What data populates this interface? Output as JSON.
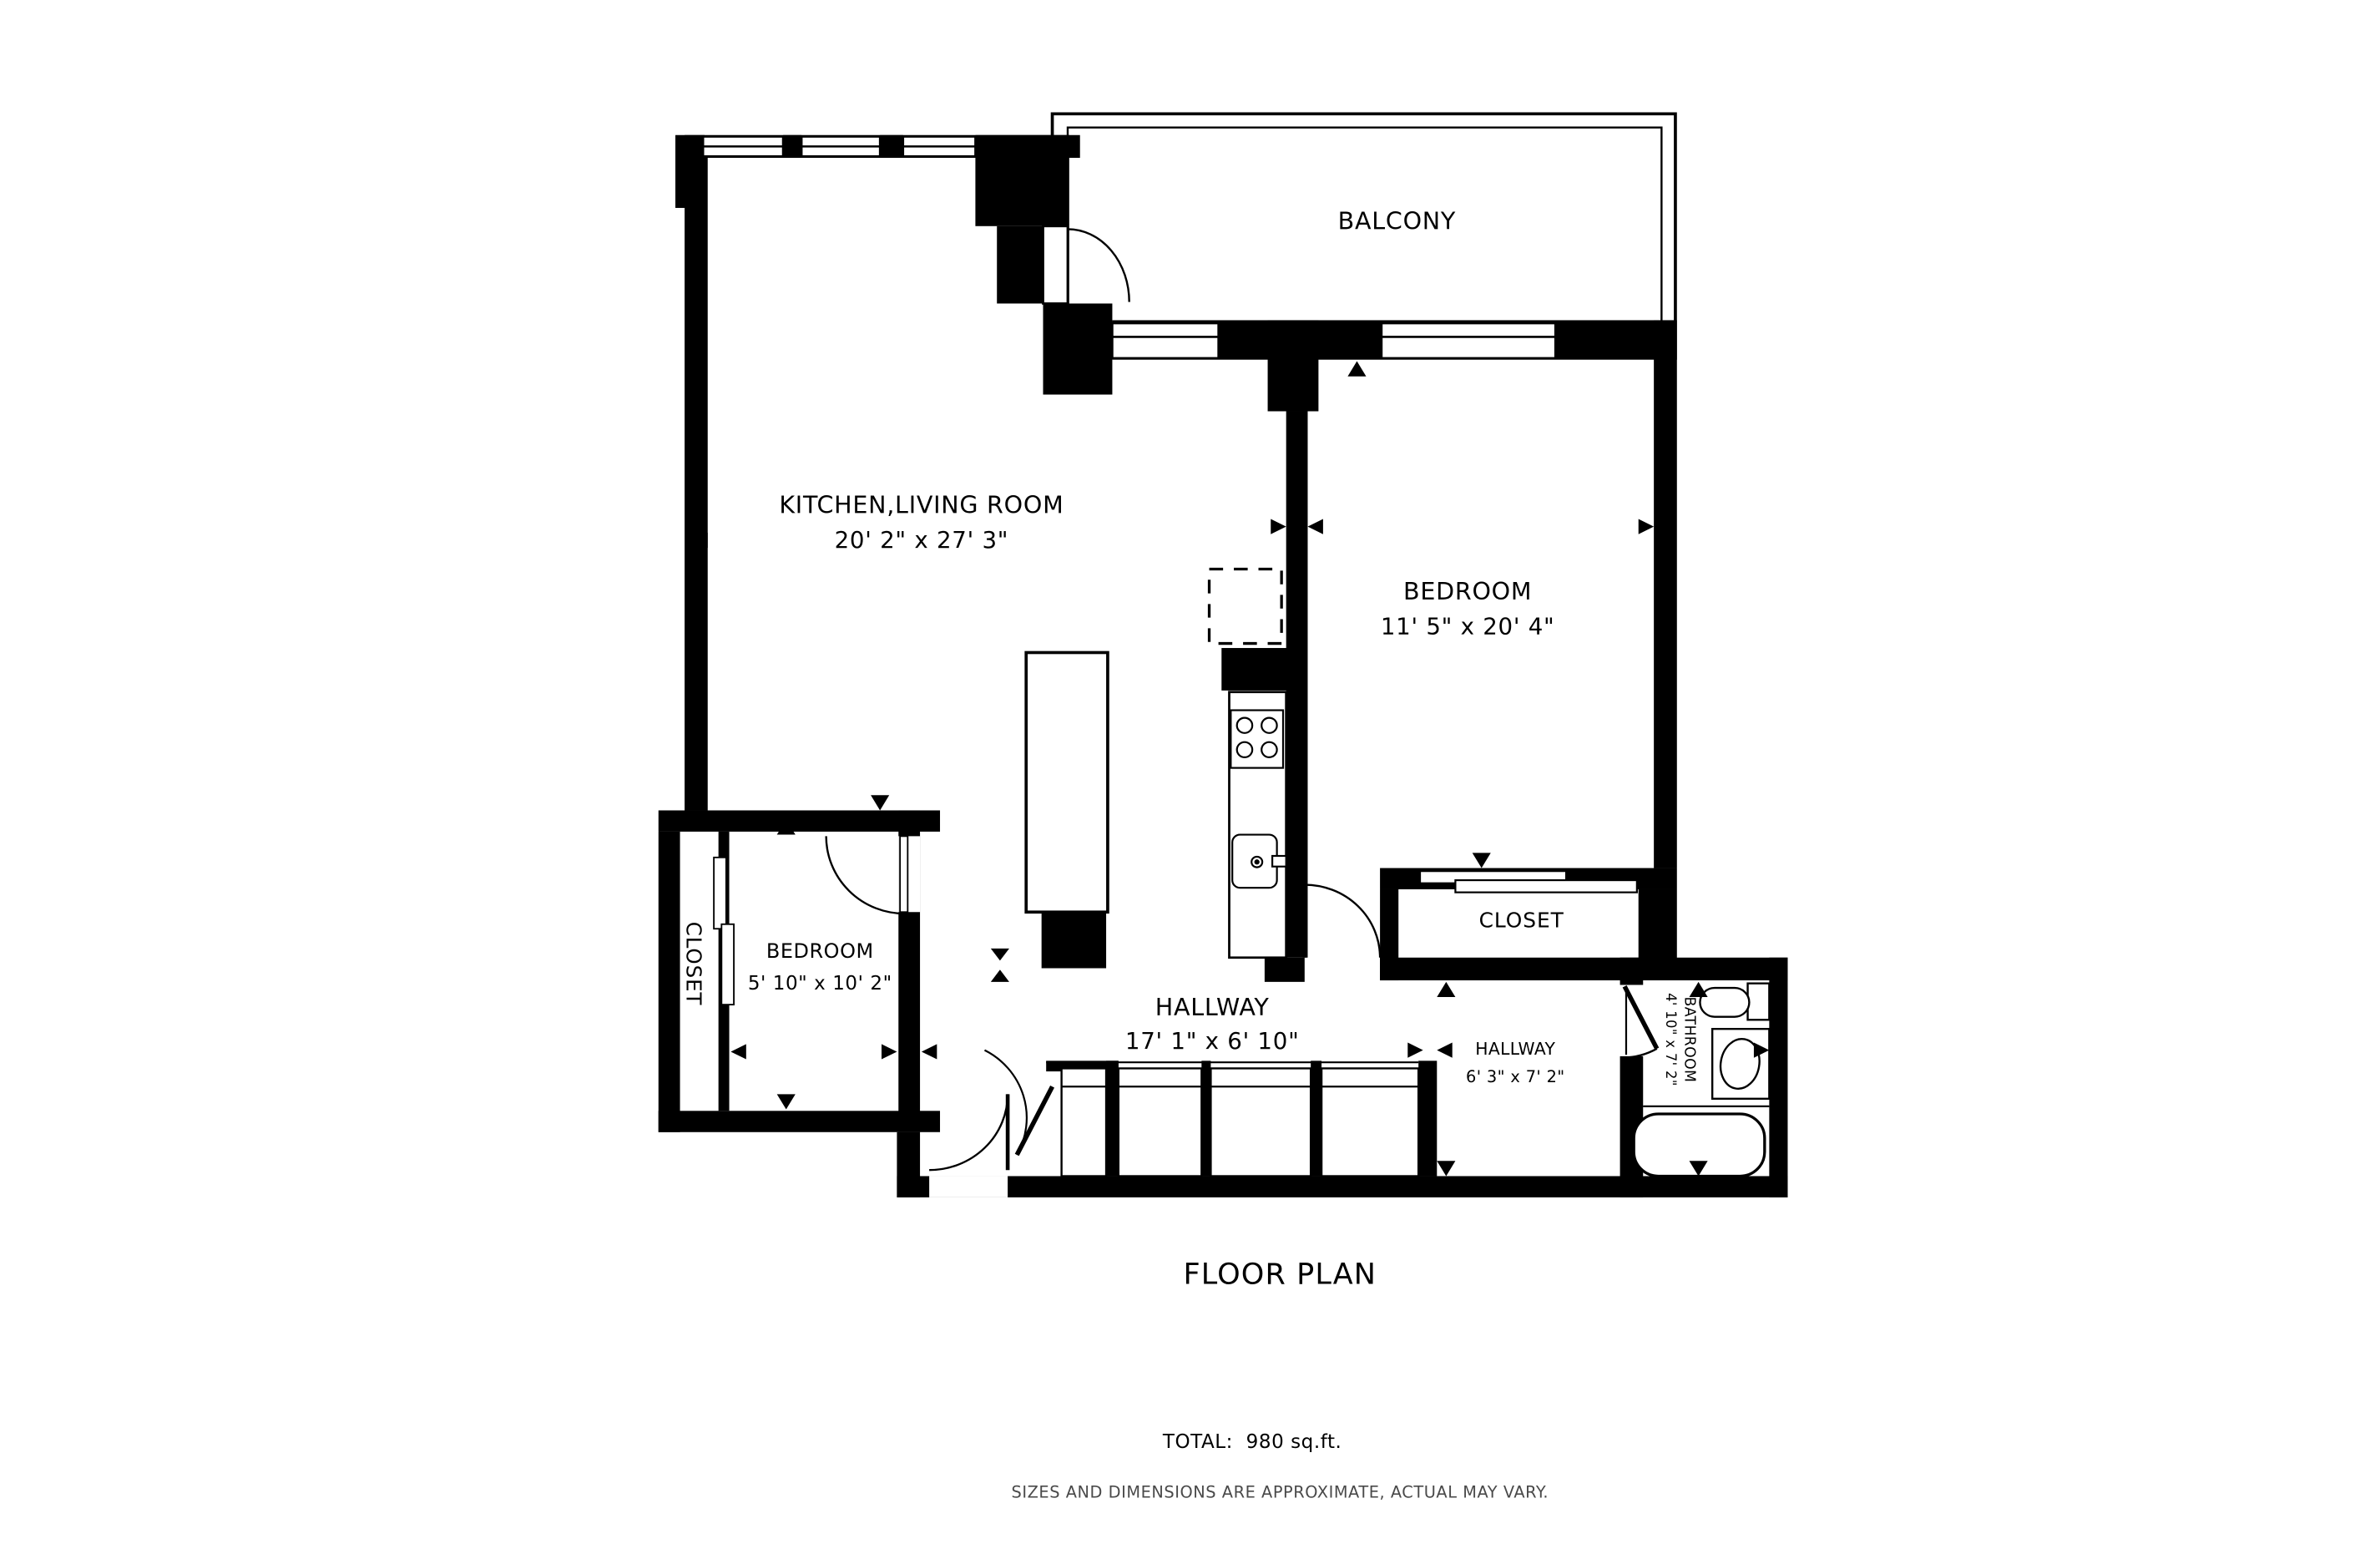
{
  "plan": {
    "title": "FLOOR PLAN",
    "total_label": "TOTAL:  980 sq.ft.",
    "disclaimer": "SIZES AND DIMENSIONS ARE APPROXIMATE, ACTUAL MAY VARY.",
    "rooms": {
      "kitchen_living": {
        "name": "KITCHEN,LIVING ROOM",
        "dims": "20' 2\" x 27' 3\""
      },
      "bedroom": {
        "name": "BEDROOM",
        "dims": "11' 5\" x 20' 4\""
      },
      "bedroom_small": {
        "name": "BEDROOM",
        "dims": "5' 10\" x 10' 2\""
      },
      "balcony": {
        "name": "BALCONY"
      },
      "closet_left": {
        "name": "CLOSET"
      },
      "closet_right": {
        "name": "CLOSET"
      },
      "hallway_main": {
        "name": "HALLWAY",
        "dims": "17' 1\" x 6' 10\""
      },
      "hallway_small": {
        "name": "HALLWAY",
        "dims": "6' 3\" x 7' 2\""
      },
      "bathroom": {
        "name": "BATHROOM",
        "dims": "4' 10\" x 7' 2\""
      }
    },
    "colors": {
      "wall": "#000000",
      "background": "#ffffff",
      "note": "#4a4a4a"
    }
  }
}
